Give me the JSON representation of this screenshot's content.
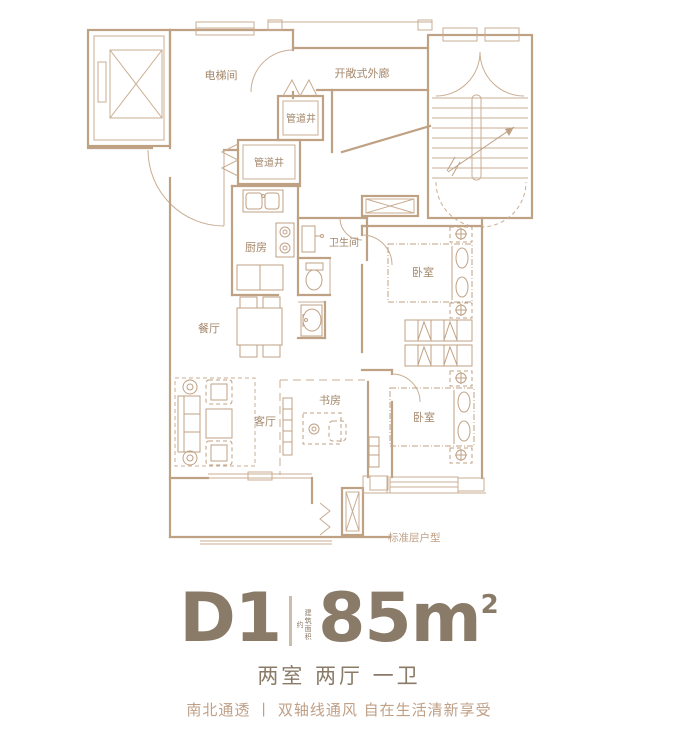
{
  "colors": {
    "plan_line": "#bfa184",
    "plan_label": "#a3876a",
    "title_text": "#8a7b68",
    "tagline_text": "#bfa087",
    "background": "#ffffff"
  },
  "plan": {
    "labels": {
      "elevator_hall": "电梯间",
      "open_corridor": "开敞式外廊",
      "pipe_shaft_upper": "管道井",
      "pipe_shaft_lower": "管道井",
      "kitchen": "厨房",
      "bathroom": "卫生间",
      "bedroom_north": "卧室",
      "bedroom_south": "卧室",
      "dining": "餐厅",
      "living": "客厅",
      "study": "书房",
      "caption": "标准层户型"
    }
  },
  "info": {
    "unit_code": "D1",
    "area_prefix": "建筑面积约",
    "area_value": "85m",
    "area_superscript": "2",
    "layout_summary": "两室 两厅 一卫",
    "tagline": "南北通透 丨 双轴线通风 自在生活清新享受"
  }
}
